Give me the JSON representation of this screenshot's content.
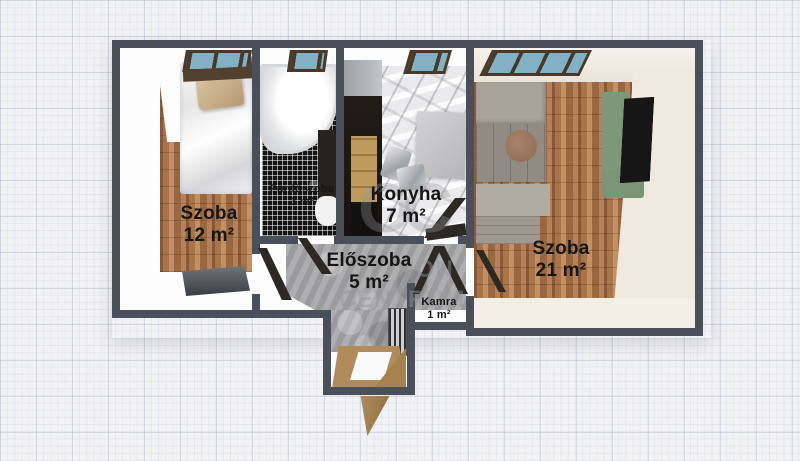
{
  "watermark": {
    "monogram": "OC",
    "line1": "OTTHON",
    "line2": "CENTRUM"
  },
  "rooms": {
    "bedroom_small": {
      "name": "Szoba",
      "area": "12 m²"
    },
    "bathroom": {
      "name": "Fürdőszoba",
      "area": "3 m²"
    },
    "kitchen": {
      "name": "Konyha",
      "area": "7 m²"
    },
    "bedroom_large": {
      "name": "Szoba",
      "area": "21 m²"
    },
    "hallway": {
      "name": "Előszoba",
      "area": "5 m²"
    },
    "pantry": {
      "name": "Kamra",
      "area": "1 m²"
    }
  },
  "colors": {
    "wall": "#49505a",
    "window_glass": "#82b0c4",
    "window_frame": "#4a3829",
    "wood_floor": "#a9744a",
    "marble_floor": "#ebebed",
    "concrete_floor": "#a5a5a7",
    "mosaic_floor": "#141414",
    "accent_green": "#7e9778",
    "entrance_wood": "#b08c5c",
    "label_text": "#151515"
  }
}
